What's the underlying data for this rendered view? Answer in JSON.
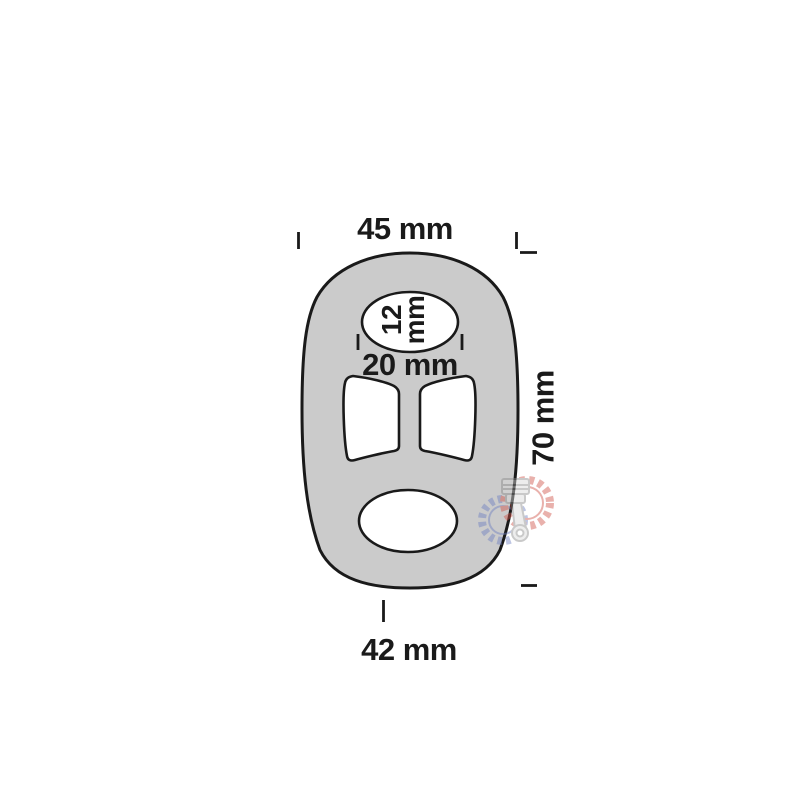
{
  "diagram": {
    "description": "technical dimension drawing of an oval rubber exhaust hanger with three cut-outs",
    "labels": {
      "top_width": "45 mm",
      "inner_hole": "12\nmm",
      "slot_width": "20 mm",
      "height": "70 mm",
      "bottom_width": "42 mm"
    },
    "colors": {
      "part_fill": "#cbcbcb",
      "outline": "#1a1a1a",
      "watermark_red": "#cf5348",
      "watermark_blue": "#6e7fc0",
      "watermark_gray": "#8a8a8a"
    }
  }
}
